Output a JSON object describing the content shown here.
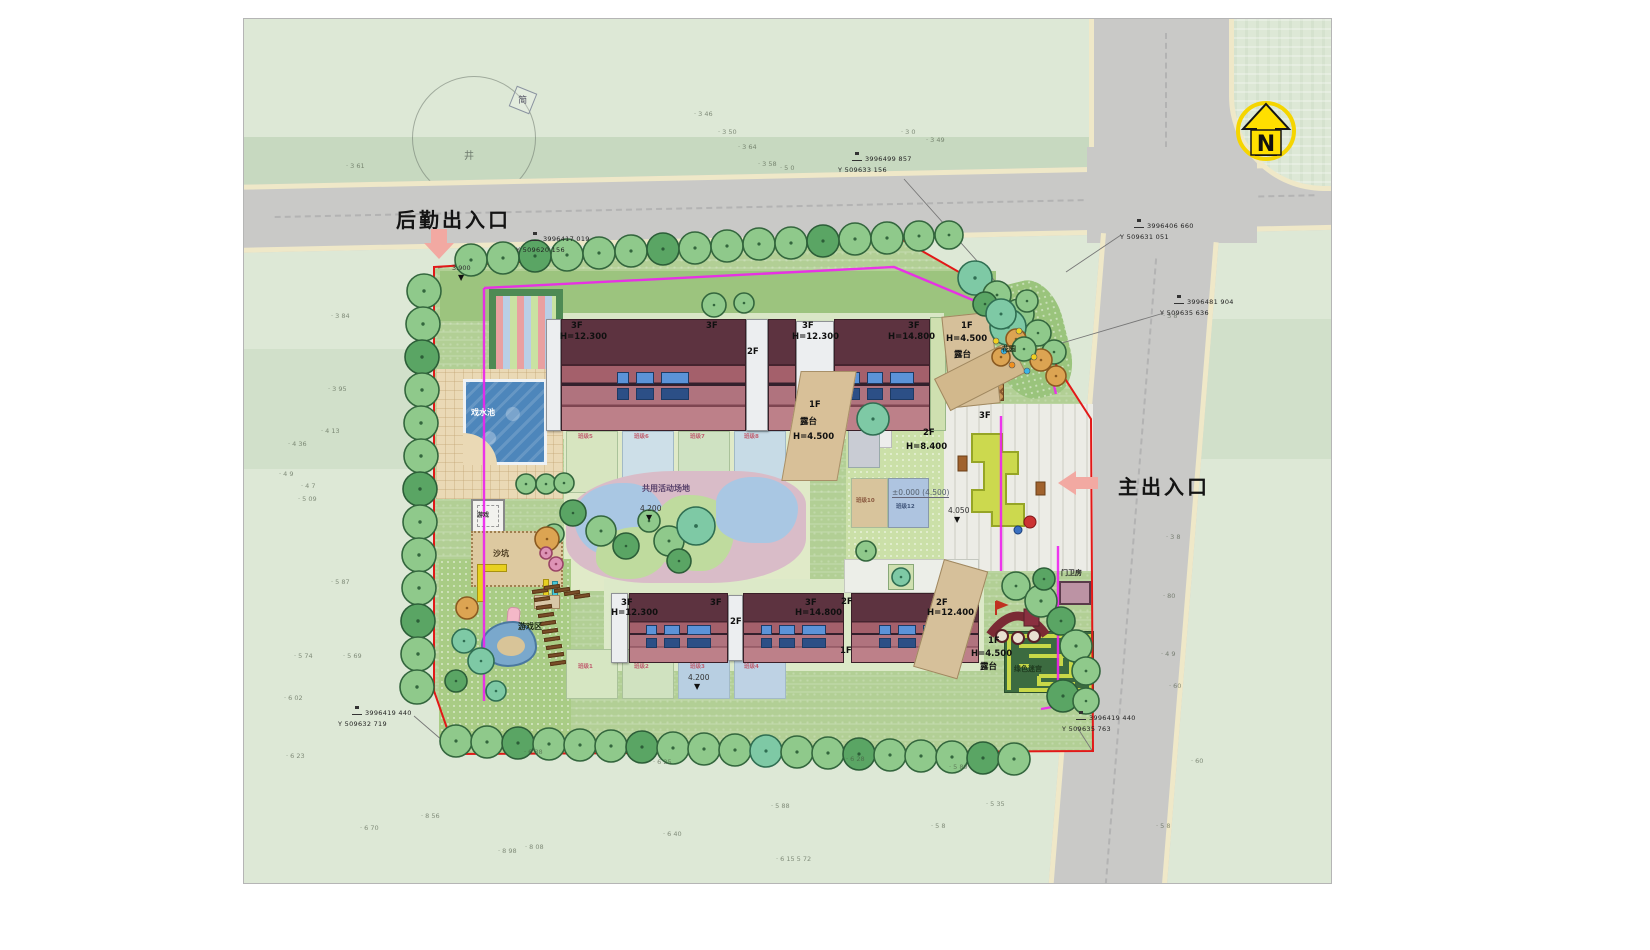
{
  "compass": {
    "letter": "N"
  },
  "survey_marker": {
    "label": "简",
    "well": "井"
  },
  "entrances": [
    {
      "id": "service",
      "label": "后勤出入口",
      "x": 152,
      "y": 185,
      "arrow": "down"
    },
    {
      "id": "main",
      "label": "主出入口",
      "x": 874,
      "y": 452,
      "arrow": "left"
    }
  ],
  "level_markers": [
    {
      "t": "3.900",
      "x": 208,
      "y": 246,
      "tri": 1,
      "small": 1
    },
    {
      "t": "4.200",
      "x": 396,
      "y": 486,
      "tri": 1
    },
    {
      "t": "4.200",
      "x": 444,
      "y": 655,
      "tri": 1
    },
    {
      "t": "4.050",
      "x": 704,
      "y": 488,
      "tri": 1
    },
    {
      "t": "±0.000 (4.500)",
      "x": 648,
      "y": 470,
      "tri": 0,
      "pm": 1
    }
  ],
  "building_labels": [
    {
      "t": "3F",
      "x": 327,
      "y": 303
    },
    {
      "t": "H=12.300",
      "x": 316,
      "y": 314
    },
    {
      "t": "3F",
      "x": 462,
      "y": 303
    },
    {
      "t": "2F",
      "x": 503,
      "y": 329
    },
    {
      "t": "3F",
      "x": 558,
      "y": 303
    },
    {
      "t": "H=12.300",
      "x": 548,
      "y": 314
    },
    {
      "t": "3F",
      "x": 664,
      "y": 303
    },
    {
      "t": "H=14.800",
      "x": 644,
      "y": 314
    },
    {
      "t": "1F",
      "x": 717,
      "y": 303
    },
    {
      "t": "H=4.500",
      "x": 702,
      "y": 316
    },
    {
      "t": "露台",
      "x": 710,
      "y": 332
    },
    {
      "t": "1F",
      "x": 565,
      "y": 382
    },
    {
      "t": "露台",
      "x": 556,
      "y": 399
    },
    {
      "t": "H=4.500",
      "x": 549,
      "y": 414
    },
    {
      "t": "2F",
      "x": 679,
      "y": 410
    },
    {
      "t": "H=8.400",
      "x": 662,
      "y": 424
    },
    {
      "t": "3F",
      "x": 735,
      "y": 393
    },
    {
      "t": "3F",
      "x": 377,
      "y": 580
    },
    {
      "t": "H=12.300",
      "x": 367,
      "y": 590
    },
    {
      "t": "3F",
      "x": 466,
      "y": 580
    },
    {
      "t": "2F",
      "x": 486,
      "y": 599
    },
    {
      "t": "3F",
      "x": 561,
      "y": 580
    },
    {
      "t": "H=14.800",
      "x": 551,
      "y": 590
    },
    {
      "t": "2F",
      "x": 597,
      "y": 579
    },
    {
      "t": "2F",
      "x": 692,
      "y": 580
    },
    {
      "t": "H=12.400",
      "x": 683,
      "y": 590
    },
    {
      "t": "1F",
      "x": 596,
      "y": 628
    },
    {
      "t": "1F",
      "x": 744,
      "y": 618
    },
    {
      "t": "H=4.500",
      "x": 727,
      "y": 631
    },
    {
      "t": "露台",
      "x": 736,
      "y": 644
    }
  ],
  "area_labels": [
    {
      "t": "戏水池",
      "x": 227,
      "y": 390,
      "s": 8,
      "c": "#ffffff"
    },
    {
      "t": "游戏",
      "x": 233,
      "y": 494,
      "s": 6,
      "c": "#333333"
    },
    {
      "t": "沙坑",
      "x": 249,
      "y": 531,
      "s": 8,
      "c": "#4a3a20"
    },
    {
      "t": "游戏区",
      "x": 274,
      "y": 604,
      "s": 8,
      "c": "#1c2a14"
    },
    {
      "t": "共用活动场地",
      "x": 398,
      "y": 466,
      "s": 8,
      "c": "#57406a"
    },
    {
      "t": "花园",
      "x": 758,
      "y": 327,
      "s": 7,
      "c": "#203018"
    },
    {
      "t": "门卫房",
      "x": 817,
      "y": 551,
      "s": 7,
      "c": "#222222"
    },
    {
      "t": "绿色迷宫",
      "x": 770,
      "y": 647,
      "s": 7,
      "c": "#1e3a1e"
    },
    {
      "t": "班级5",
      "x": 334,
      "y": 416,
      "s": 5.5,
      "c": "#c06070"
    },
    {
      "t": "班级6",
      "x": 390,
      "y": 416,
      "s": 5.5,
      "c": "#c06070"
    },
    {
      "t": "班级7",
      "x": 446,
      "y": 416,
      "s": 5.5,
      "c": "#c06070"
    },
    {
      "t": "班级8",
      "x": 500,
      "y": 416,
      "s": 5.5,
      "c": "#c06070"
    },
    {
      "t": "班级10",
      "x": 612,
      "y": 480,
      "s": 5.5,
      "c": "#8a5a40"
    },
    {
      "t": "班级12",
      "x": 652,
      "y": 486,
      "s": 5.5,
      "c": "#40557a"
    },
    {
      "t": "班级1",
      "x": 334,
      "y": 646,
      "s": 5.5,
      "c": "#c06070"
    },
    {
      "t": "班级2",
      "x": 390,
      "y": 646,
      "s": 5.5,
      "c": "#c06070"
    },
    {
      "t": "班级3",
      "x": 446,
      "y": 646,
      "s": 5.5,
      "c": "#c06070"
    },
    {
      "t": "班级4",
      "x": 500,
      "y": 646,
      "s": 5.5,
      "c": "#c06070"
    }
  ],
  "coordinate_callouts": [
    {
      "x": 286,
      "y": 216,
      "l1": "3996417  019",
      "l2": "Y 509620  156",
      "leader": [
        294,
        230,
        194,
        249
      ]
    },
    {
      "x": 608,
      "y": 136,
      "l1": "3996499  857",
      "l2": "Y 509633  156",
      "leader": [
        660,
        160,
        767,
        280
      ]
    },
    {
      "x": 890,
      "y": 203,
      "l1": "3996406  660",
      "l2": "Y 509631  051",
      "leader": [
        877,
        216,
        822,
        253
      ]
    },
    {
      "x": 930,
      "y": 279,
      "l1": "3996481  904",
      "l2": "Y 509635  636",
      "leader": [
        920,
        294,
        801,
        329
      ]
    },
    {
      "x": 108,
      "y": 690,
      "l1": "3996419  440",
      "l2": "Y 509632  719",
      "leader": [
        170,
        697,
        213,
        734
      ]
    },
    {
      "x": 832,
      "y": 695,
      "l1": "3996419  440",
      "l2": "Y 509635  763",
      "leader": [
        833,
        708,
        849,
        733
      ]
    }
  ],
  "spot_elevations": [
    [
      450,
      92,
      "3 46"
    ],
    [
      474,
      110,
      "3 50"
    ],
    [
      494,
      125,
      "3 64"
    ],
    [
      514,
      142,
      "3 58"
    ],
    [
      536,
      146,
      "5 0"
    ],
    [
      657,
      110,
      "3 0"
    ],
    [
      682,
      118,
      "3 49"
    ],
    [
      102,
      144,
      "3 61"
    ],
    [
      87,
      294,
      "3 84"
    ],
    [
      84,
      367,
      "3 95"
    ],
    [
      44,
      422,
      "4 36"
    ],
    [
      77,
      409,
      "4 13"
    ],
    [
      35,
      452,
      "4 9"
    ],
    [
      57,
      464,
      "4 7"
    ],
    [
      54,
      477,
      "5 09"
    ],
    [
      87,
      560,
      "5 87"
    ],
    [
      50,
      634,
      "5 74"
    ],
    [
      99,
      634,
      "5 69"
    ],
    [
      40,
      676,
      "6 02"
    ],
    [
      42,
      734,
      "6 23"
    ],
    [
      280,
      730,
      "6 38"
    ],
    [
      409,
      740,
      "6 25"
    ],
    [
      602,
      737,
      "6 28"
    ],
    [
      705,
      745,
      "5 89"
    ],
    [
      742,
      782,
      "5 35"
    ],
    [
      687,
      804,
      "5 8"
    ],
    [
      527,
      784,
      "5 88"
    ],
    [
      419,
      812,
      "6 40"
    ],
    [
      254,
      829,
      "8 98"
    ],
    [
      281,
      825,
      "8 08"
    ],
    [
      177,
      794,
      "8 56"
    ],
    [
      116,
      806,
      "6 70"
    ],
    [
      532,
      837,
      "6 15  5 72"
    ],
    [
      919,
      294,
      "3 8"
    ],
    [
      922,
      515,
      "3 8"
    ],
    [
      919,
      574,
      "80"
    ],
    [
      917,
      632,
      "4 9"
    ],
    [
      925,
      664,
      "60"
    ],
    [
      947,
      739,
      "60"
    ],
    [
      912,
      804,
      "5 8"
    ]
  ],
  "colors": {
    "boundary": "#e21818",
    "path_magenta": "#ee22ee",
    "road": "#c9c9c7",
    "road_edge": "#efe8c8",
    "lawn": "#dde8d6",
    "site_green": "#b2cf95",
    "pool_blue": "#4d86bb",
    "roof_dark": "#5d3340",
    "roof_light": "#b0737e",
    "entrance_arrow_pink": "#f2a9a2",
    "north_yellow": "#ffdf00",
    "trees": {
      "g": {
        "fill": "#8fc98b",
        "stroke": "#33663d"
      },
      "d": {
        "fill": "#5aa564",
        "stroke": "#2c5e38"
      },
      "t": {
        "fill": "#7ec9a5",
        "stroke": "#2f6e52"
      },
      "o": {
        "fill": "#dca452",
        "stroke": "#8a5a20"
      },
      "p": {
        "fill": "#dd93b5",
        "stroke": "#994466"
      }
    }
  }
}
